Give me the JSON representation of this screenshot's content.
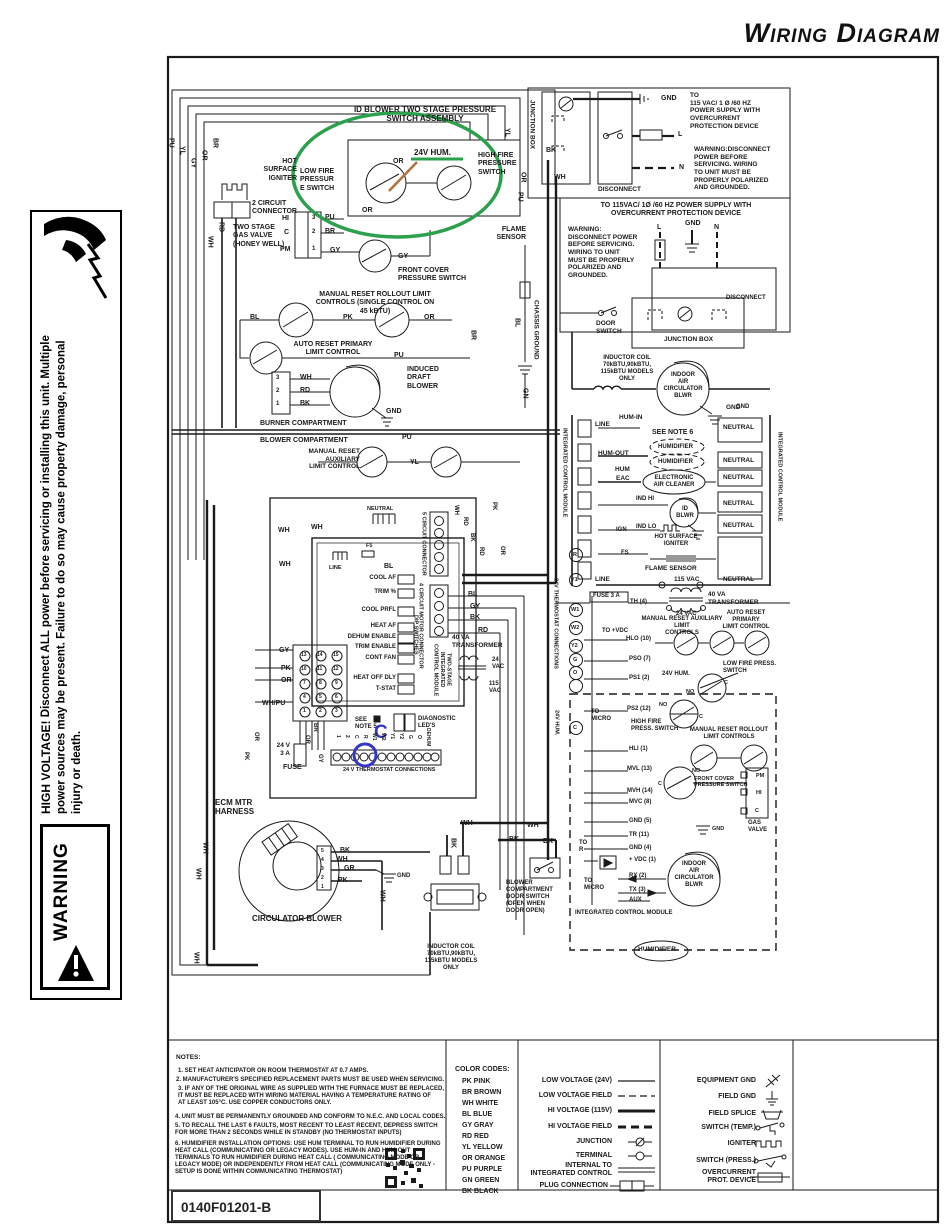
{
  "title": "Wiring Diagram",
  "part_number": "0140F01201-B",
  "warning_banner": {
    "label": "WARNING",
    "heading": "HIGH VOLTAGE!",
    "body": "Disconnect ALL power before servicing or installing this unit. Multiple power sources may be present. Failure to do so may cause property damage, personal injury or death."
  },
  "wire": {
    "pu": "PU",
    "yl": "YL",
    "gy": "GY",
    "or": "OR",
    "br": "BR",
    "rd": "RD",
    "wh": "WH",
    "bk": "BK",
    "bl": "BL",
    "pk": "PK",
    "gn": "GN",
    "gr": "GR",
    "whpu": "WH/PU"
  },
  "term": {
    "c": "C",
    "no": "NO"
  },
  "pins": {
    "p1": "1",
    "p2": "2",
    "p3": "3",
    "p4": "4",
    "p5": "5",
    "p6": "6",
    "p7": "7",
    "p8": "8",
    "p9": "9",
    "p10": "10",
    "p11": "11",
    "p12": "12",
    "p13": "13",
    "p14": "14",
    "p15": "15"
  },
  "power1": {
    "junction_box": "JUNCTION BOX",
    "disconnect": "DISCONNECT",
    "gnd": "GND",
    "l": "L",
    "n": "N",
    "supply": "TO\n115 VAC/ 1 Ø /60 HZ\nPOWER SUPPLY WITH\nOVERCURRENT\nPROTECTION DEVICE",
    "warning": "WARNING:DISCONNECT\nPOWER BEFORE\nSERVICING. WIRING\nTO UNIT MUST BE\nPROPERLY POLARIZED\nAND GROUNDED."
  },
  "power2": {
    "supply": "TO 115VAC/ 1Ø /60 HZ POWER SUPPLY WITH\nOVERCURRENT PROTECTION DEVICE",
    "warning": "WARNING:\nDISCONNECT POWER\nBEFORE SERVICING.\nWIRING TO UNIT\nMUST BE PROPERLY\nPOLARIZED AND\nGROUNDED.",
    "l": "L",
    "gnd": "GND",
    "n": "N",
    "disconnect": "DISCONNECT",
    "door_switch": "DOOR\nSWITCH",
    "junction_box": "JUNCTION BOX",
    "inductor": "INDUCTOR COIL\n70kBTU,90kBTU,\n115kBTU MODELS\nONLY",
    "blower": "INDOOR\nAIR\nCIRCULATOR\nBLWR",
    "gnd2": "GND"
  },
  "burner": {
    "psa_title": "ID BLOWER TWO STAGE PRESSURE\nSWITCH ASSEMBLY",
    "hum24": "24V HUM.",
    "low_fire": "LOW FIRE\nPRESSUR\nE SWITCH",
    "high_fire": "HIGH FIRE\nPRESSURE\nSWITCH",
    "hot_surface": "HOT\nSURFACE\nIGNITER",
    "conn2": "2 CIRCUIT\nCONNECTOR",
    "gas_valve": "TWO STAGE\nGAS VALVE\n(HONEY WELL)",
    "gv_hi": "HI",
    "gv_c": "C",
    "gv_pm": "PM",
    "front_cover": "FRONT COVER\nPRESSURE SWITCH",
    "rollout_title": "MANUAL RESET ROLLOUT LIMIT\nCONTROLS (SINGLE CONTROL ON\n45 kBTU)",
    "auto_reset": "AUTO RESET PRIMARY\nLIMIT CONTROL",
    "induced": "INDUCED\nDRAFT\nBLOWER",
    "gnd": "GND",
    "burner_comp": "BURNER COMPARTMENT",
    "blower_comp": "BLOWER COMPARTMENT",
    "aux_limit": "MANUAL RESET\nAUXILIARY\nLIMIT CONTROL",
    "flame_sensor": "FLAME\nSENSOR",
    "chassis_ground": "CHASSIS GROUND"
  },
  "icm115": {
    "module_v": "INTEGRATED CONTROL MODULE",
    "line": "LINE",
    "hum_in": "HUM-IN",
    "see_note6": "SEE NOTE 6",
    "humidifier": "HUMIDIFIER",
    "hum_out": "HUM-OUT",
    "hum": "HUM",
    "eac": "EAC",
    "eac_label": "ELECTRONIC\nAIR CLEANER",
    "ind_hi": "IND HI",
    "id_blwr": "ID\nBLWR",
    "ind_lo": "IND LO",
    "ign": "IGN",
    "hsi": "HOT SURFACE\nIGNITER",
    "fs": "FS",
    "flame_sensor": "FLAME SENSOR",
    "vac115": "115 VAC",
    "neutral": "NEUTRAL",
    "gnd": "GND"
  },
  "lv": {
    "fuse3a": "FUSE 3 A",
    "th4": "TH (4)",
    "vac24": "24 VAC",
    "tfmr40": "40 VA\nTRANSFORMER",
    "to_vdc": "TO +VDC",
    "aux_title": "MANUAL RESET AUXILIARY LIMIT\nCONTROLS",
    "arp_title": "AUTO RESET PRIMARY\nLIMIT CONTROL",
    "hlo": "HLO (10)",
    "pso": "PSO (7)",
    "ps1": "PS1 (2)",
    "hum24": "24V HUM.",
    "low_fire": "LOW FIRE PRESS.\nSWITCH",
    "ps2": "PS2 (12)",
    "high_fire": "HIGH FIRE\nPRESS. SWITCH",
    "to_micro": "TO\nMICRO",
    "rollout": "MANUAL RESET ROLLOUT\nLIMIT CONTROLS",
    "hli": "HLI (1)",
    "mvl": "MVL (13)",
    "front_cover": "FRONT COVER\nPRESSURE SWITCH",
    "mvh": "MVH (14)",
    "mvc": "MVC (8)",
    "gnd5": "GND (5)",
    "gnd_lbl": "GND",
    "tr11": "TR (11)",
    "gnd4": "GND (4)",
    "vdc1": "+ VDC (1)",
    "to_r": "TO\nR",
    "rx": "RX (2)",
    "tx": "TX (3)",
    "aux": "AUX",
    "blower": "INDOOR\nAIR\nCIRCULATOR\nBLWR",
    "gas_valve": "GAS\nVALVE",
    "gv_pm": "PM",
    "gv_hi": "HI",
    "gv_c": "C",
    "icm": "INTEGRATED CONTROL MODULE",
    "humidifier": "HUMIDIFIER",
    "tstat_v": "24V THERMOSTAT CONNECTIONS",
    "hum24_v": "24V HUM.",
    "t_r": "R",
    "t_y1": "Y1",
    "t_w1": "W1",
    "t_w2": "W2",
    "t_y2": "Y2",
    "t_g": "G",
    "t_o": "O",
    "t_c": "C"
  },
  "center": {
    "conn5_v": "5 CIRCUIT CONNECTOR",
    "conn4_v": "4 CIRCUIT MOTOR CONNECTOR",
    "neutral": "NEUTRAL",
    "line": "LINE",
    "f5": "F5",
    "dip_rows": [
      "COOL AF",
      "TRIM %",
      "COOL PRFL",
      "HEAT AF",
      "DEHUM ENABLE",
      "TRIM ENABLE",
      "CONT FAN",
      "HEAT OFF DLY",
      "T-STAT"
    ],
    "dip_v": "DIP SWITCHES",
    "module_v": "TWO-STAGE\nINTEGRATED\nCONTROL MODULE",
    "tfmr40": "40 VA\nTRANSFORMER",
    "vac24": "24\nVAC",
    "vac115": "115\nVAC",
    "fuse": "24 V\n3 A",
    "fuse_lbl": "FUSE",
    "see_note5": "SEE\nNOTE 5",
    "diag_leds": "DIAGNOSTIC\nLED'S",
    "tstat_strip": "24 V THERMOSTAT CONNECTIONS",
    "strip_terms": [
      "1",
      "2",
      "C",
      "R",
      "W1",
      "W2",
      "Y1",
      "Y2",
      "G",
      "O",
      "DEHUM"
    ],
    "ecm": "ECM MTR\nHARNESS",
    "circ_blower": "CIRCULATOR BLOWER",
    "gnd": "GND",
    "door_switch": "BLOWER\nCOMPARTMENT\nDOOR SWITCH\n(OPEN WHEN\nDOOR OPEN)",
    "inductor": "INDUCTOR COIL\n70kBTU,90kBTU,\n115kBTU MODELS\nONLY",
    "c_annotation": "C"
  },
  "legend": {
    "notes": [
      "NOTES:",
      "1. SET HEAT ANTICIPATOR ON ROOM THERMOSTAT AT 0.7 AMPS.",
      "2. MANUFACTURER'S SPECIFIED REPLACEMENT PARTS MUST BE USED WHEN SERVICING.",
      "3. IF ANY OF THE ORIGINAL WIRE AS SUPPLIED WITH THE FURNACE MUST BE REPLACED,\nIT MUST BE REPLACED WITH WIRING MATERIAL HAVING A TEMPERATURE RATING OF\nAT LEAST 105°C. USE COPPER CONDUCTORS ONLY.",
      "4. UNIT MUST BE PERMANENTLY GROUNDED AND CONFORM TO N.E.C. AND LOCAL CODES.",
      "5. TO RECALL THE LAST 6 FAULTS, MOST RECENT TO LEAST RECENT, DEPRESS SWITCH\nFOR MORE THAN 2 SECONDS WHILE IN STANDBY (NO THERMOSTAT INPUTS)",
      "6. HUMIDIFIER INSTALLATION OPTIONS: USE HUM TERMINAL TO RUN HUMIDIFIER DURING\nHEAT CALL (COMMUNICATING OR LEGACY MODES). USE HUM-IN AND HUM-OUT\nTERMINALS TO RUN HUMIDIFIER DURING HEAT CALL ( COMMUNICATING MODE OR\nLEGACY MODE) OR INDEPENDENTLY FROM HEAT CALL (COMMUNICATING MODE ONLY -\nSETUP IS DONE WITHIN COMMUNICATING THERMOSTAT)"
    ],
    "color_heading": "COLOR CODES:",
    "color_codes": [
      "PK PINK",
      "BR BROWN",
      "WH WHITE",
      "BL BLUE",
      "GY GRAY",
      "RD RED",
      "YL YELLOW",
      "OR ORANGE",
      "PU  PURPLE",
      "GN GREEN",
      "BK BLACK"
    ],
    "line_rows": [
      "LOW VOLTAGE (24V)",
      "LOW VOLTAGE FIELD",
      "HI VOLTAGE (115V)",
      "HI VOLTAGE FIELD",
      "JUNCTION",
      "TERMINAL",
      "INTERNAL TO\nINTEGRATED CONTROL",
      "PLUG CONNECTION"
    ],
    "symbol_rows": [
      "EQUIPMENT GND",
      "FIELD GND",
      "FIELD SPLICE",
      "SWITCH (TEMP.)",
      "IGNITER",
      "SWITCH (PRESS.)",
      "OVERCURRENT\nPROT. DEVICE"
    ]
  },
  "colors": {
    "annotation_green": "#2ca04c",
    "annotation_blue": "#3535c8",
    "annotation_orange": "#b5713f",
    "ink": "#1a1a1a"
  }
}
